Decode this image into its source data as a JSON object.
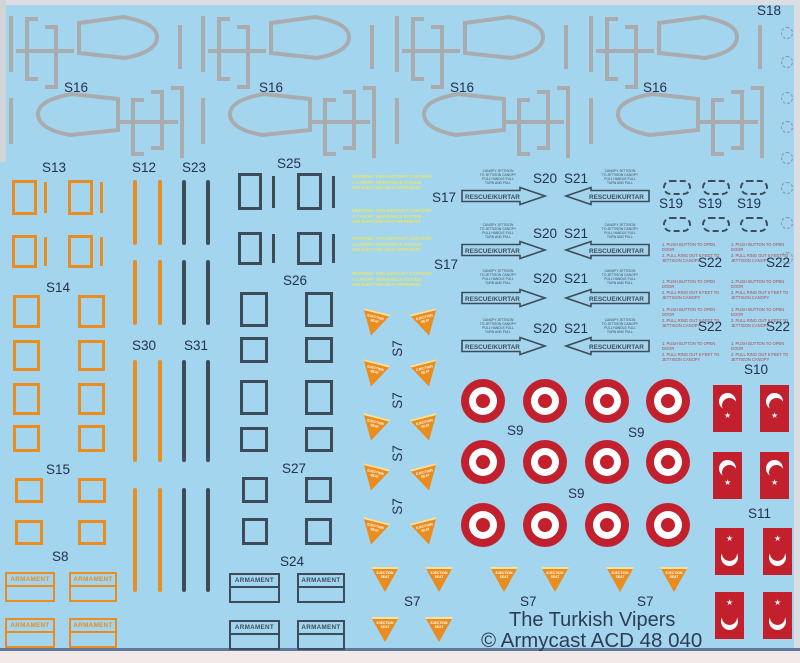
{
  "sheet": {
    "product_line1": "The Turkish Vipers",
    "product_line2": "© Armycast ACD 48 040"
  },
  "labels": {
    "s7": "S7",
    "s8": "S8",
    "s9": "S9",
    "s10": "S10",
    "s11": "S11",
    "s12": "S12",
    "s13": "S13",
    "s14": "S14",
    "s15": "S15",
    "s16": "S16",
    "s17": "S17",
    "s18": "S18",
    "s19": "S19",
    "s20": "S20",
    "s21": "S21",
    "s22": "S22",
    "s23": "S23",
    "s24": "S24",
    "s25": "S25",
    "s26": "S26",
    "s27": "S27",
    "s30": "S30",
    "s31": "S31"
  },
  "decals": {
    "armament": "ARMAMENT",
    "rescue_arrow": "RESCUE/KURTAR",
    "canopy_instructions": [
      "1. PUSH BUTTON TO OPEN DOOR",
      "2. PULL RING OUT 6 FEET TO",
      "JETTISON CANOPY"
    ],
    "warning_stencil": [
      "WARNING: THIS AIRCRAFT CONTAINS",
      "A CANOPY SEVERANCE SYSTEM",
      "SEE EJECTION SEAT WARNINGS"
    ],
    "jettison_stencil": [
      "CANOPY JETTISON",
      "TO JETTISON CANOPY",
      "PULL HANDLE FULL",
      "TURN AND PULL"
    ],
    "ejection_triangle": [
      "EJECTION",
      "SEAT"
    ]
  },
  "colors": {
    "background": "#a3d5ee",
    "orange": "#ea8c1e",
    "slate": "#3e4c59",
    "red": "#c2202c",
    "gray_outline": "#a9abae",
    "yellow_stencil": "#e9e763",
    "label_text": "#25314d"
  }
}
